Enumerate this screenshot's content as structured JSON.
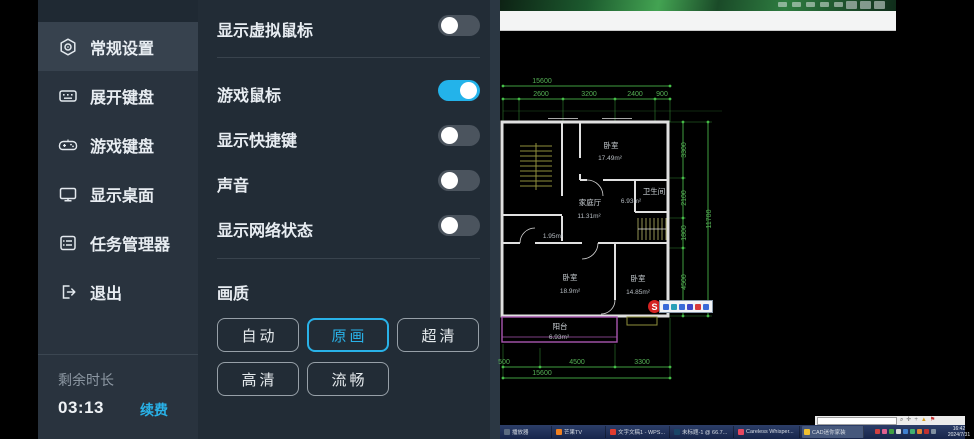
{
  "sidebar": {
    "active_label": "常规设置",
    "items": [
      {
        "label": "常规设置",
        "icon": "gear"
      },
      {
        "label": "展开键盘",
        "icon": "keyboard"
      },
      {
        "label": "游戏键盘",
        "icon": "gamepad"
      },
      {
        "label": "显示桌面",
        "icon": "monitor"
      },
      {
        "label": "任务管理器",
        "icon": "task-list"
      },
      {
        "label": "退出",
        "icon": "exit"
      }
    ],
    "footer": {
      "remaining_label": "剩余时长",
      "remaining_time": "03:13",
      "renew_label": "续费"
    }
  },
  "settings": {
    "toggles": [
      {
        "label": "显示虚拟鼠标",
        "state": "off"
      },
      {
        "label": "游戏鼠标",
        "state": "on"
      },
      {
        "label": "显示快捷键",
        "state": "off"
      },
      {
        "label": "声音",
        "state": "off"
      },
      {
        "label": "显示网络状态",
        "state": "off"
      }
    ],
    "quality": {
      "title": "画质",
      "selected": "原画",
      "options": [
        "自动",
        "原画",
        "超清",
        "高清",
        "流畅"
      ]
    }
  },
  "colors": {
    "accent": "#29b2e8",
    "toggle_on": "#23b3ea"
  },
  "desktop": {
    "widget": {
      "logo": "S"
    },
    "cad": {
      "rooms": [
        {
          "name": "卧室",
          "area": "17.49m²"
        },
        {
          "name": "家庭厅",
          "area": "11.31m²"
        },
        {
          "name": "卫生间",
          "area": "6.93m²"
        },
        {
          "name": "",
          "area": "1.95m²"
        },
        {
          "name": "卧室",
          "area": "18.9m²"
        },
        {
          "name": "卧室",
          "area": "14.85m²"
        },
        {
          "name": "阳台",
          "area": "6.93m²"
        }
      ],
      "dims": {
        "top_total": "15600",
        "top": [
          "2600",
          "3200",
          "2400",
          "900"
        ],
        "right": [
          "3300",
          "2100",
          "1800",
          "4500"
        ],
        "right_total": "11700",
        "bottom": [
          "500",
          "4500",
          "3300"
        ],
        "bottom_total": "15600"
      }
    },
    "taskbar": {
      "active": "CAD迷你家装",
      "apps": [
        {
          "label": "播放器"
        },
        {
          "label": "芒果TV"
        },
        {
          "label": "文字文稿1 - WPS..."
        },
        {
          "label": "未标题-1 @ 66.7..."
        },
        {
          "label": "Careless Whisper..."
        },
        {
          "label": "CAD迷你家装"
        }
      ],
      "clock": {
        "time": "16:42",
        "date": "2024/7/31"
      }
    }
  }
}
